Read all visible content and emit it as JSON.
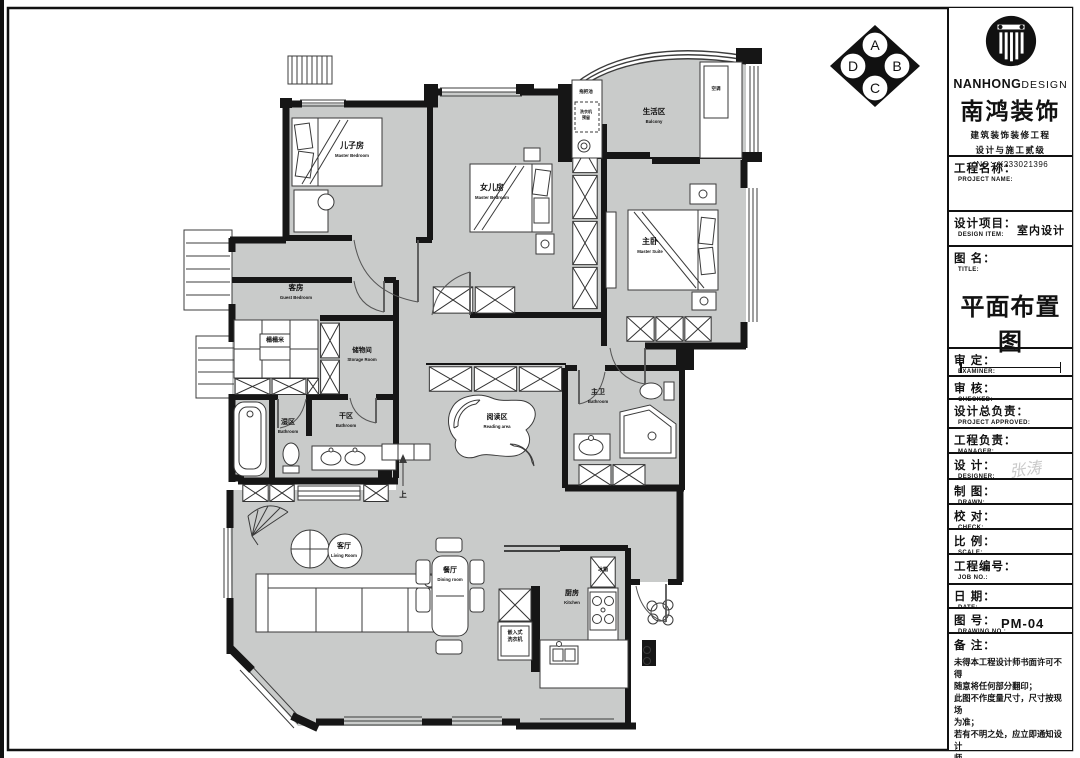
{
  "elevation": {
    "top": "A",
    "right": "B",
    "bottom": "C",
    "left": "D"
  },
  "brand": {
    "name_bold": "NANHONG",
    "name_light": "DESIGN",
    "name_cn": "南鸿装饰",
    "cert_line1": "建筑装饰装修工程",
    "cert_line2": "设计与施工贰级",
    "cert_no": "*NO：X233021396"
  },
  "title_block": {
    "project_name": {
      "cn": "工程名称：",
      "en": "PROJECT NAME:"
    },
    "design_item": {
      "cn": "设计项目：",
      "en": "DESIGN ITEM:",
      "value": "室内设计"
    },
    "drawing": {
      "cn": "图  名：",
      "en": "TITLE:",
      "value": "平面布置图"
    },
    "examiner": {
      "cn": "审  定：",
      "en": "EXAMINER:"
    },
    "checked": {
      "cn": "审  核：",
      "en": "CHECKED:"
    },
    "approved": {
      "cn": "设计总负责：",
      "en": "PROJECT APPROVED:"
    },
    "manager": {
      "cn": "工程负责：",
      "en": "MANAGER:"
    },
    "designer": {
      "cn": "设  计：",
      "en": "DESIGNER:",
      "value": "张涛"
    },
    "drawn": {
      "cn": "制  图：",
      "en": "DRAWN:"
    },
    "check": {
      "cn": "校  对：",
      "en": "CHECK:"
    },
    "scale": {
      "cn": "比  例：",
      "en": "SCALE:"
    },
    "job_no": {
      "cn": "工程编号：",
      "en": "JOB NO.:"
    },
    "date": {
      "cn": "日  期：",
      "en": "DATE:"
    },
    "drawing_no": {
      "cn": "图  号：",
      "en": "DRAWING NO.:",
      "value": "PM-04"
    },
    "remark": {
      "cn": "备  注：",
      "text": "未得本工程设计师书面许可不得\n随意将任何部分翻印；\n此图不作度量尺寸，尺寸按现场\n为准；\n若有不明之处，应立即通知设计\n师。\n本设计解释权归设计师所有。"
    }
  },
  "rooms": [
    {
      "id": "son-bedroom",
      "cn": "儿子房",
      "en": "Master Bedroom",
      "x": 352,
      "y": 148,
      "size": 8
    },
    {
      "id": "daughter-bedroom",
      "cn": "女儿房",
      "en": "Master Bedroom",
      "x": 492,
      "y": 190,
      "size": 8
    },
    {
      "id": "master-suite",
      "cn": "主卧",
      "en": "Master Suite",
      "x": 650,
      "y": 244,
      "size": 8
    },
    {
      "id": "balcony",
      "cn": "生活区",
      "en": "Balcony",
      "x": 654,
      "y": 114,
      "size": 7.5
    },
    {
      "id": "guest-bedroom",
      "cn": "客房",
      "en": "Guest Bedroom",
      "x": 296,
      "y": 290,
      "size": 7.5
    },
    {
      "id": "storage-room",
      "cn": "储物间",
      "en": "Storage Room",
      "x": 362,
      "y": 352,
      "size": 6.5
    },
    {
      "id": "wet-bathroom",
      "cn": "湿区",
      "en": "Bathroom",
      "x": 288,
      "y": 424,
      "size": 7
    },
    {
      "id": "dry-bathroom",
      "cn": "干区",
      "en": "Bathroom",
      "x": 346,
      "y": 418,
      "size": 7
    },
    {
      "id": "reading-area",
      "cn": "阅读区",
      "en": "Reading area",
      "x": 497,
      "y": 419,
      "size": 7
    },
    {
      "id": "master-bathroom",
      "cn": "主卫",
      "en": "Bathroom",
      "x": 598,
      "y": 394,
      "size": 7
    },
    {
      "id": "living-room",
      "cn": "客厅",
      "en": "Living Room",
      "x": 344,
      "y": 548,
      "size": 7
    },
    {
      "id": "dining-room",
      "cn": "餐厅",
      "en": "Dining room",
      "x": 450,
      "y": 572,
      "size": 7
    },
    {
      "id": "kitchen",
      "cn": "厨房",
      "en": "Kitchen",
      "x": 572,
      "y": 595,
      "size": 7
    }
  ],
  "plan_small_labels": [
    {
      "text": "榻榻米",
      "x": 275,
      "y": 342,
      "size": 6
    },
    {
      "text": "冰箱",
      "x": 603,
      "y": 571,
      "size": 5
    },
    {
      "text": "嵌入式",
      "x": 515,
      "y": 634,
      "size": 5
    },
    {
      "text": "洗衣机",
      "x": 515,
      "y": 641,
      "size": 5
    },
    {
      "text": "拖把池",
      "x": 586,
      "y": 93,
      "size": 4.5
    },
    {
      "text": "洗衣机",
      "x": 586,
      "y": 113,
      "size": 4
    },
    {
      "text": "预留",
      "x": 586,
      "y": 119,
      "size": 4
    },
    {
      "text": "空调",
      "x": 716,
      "y": 90,
      "size": 4.5
    },
    {
      "text": "上",
      "x": 403,
      "y": 497,
      "size": 7.5
    }
  ]
}
